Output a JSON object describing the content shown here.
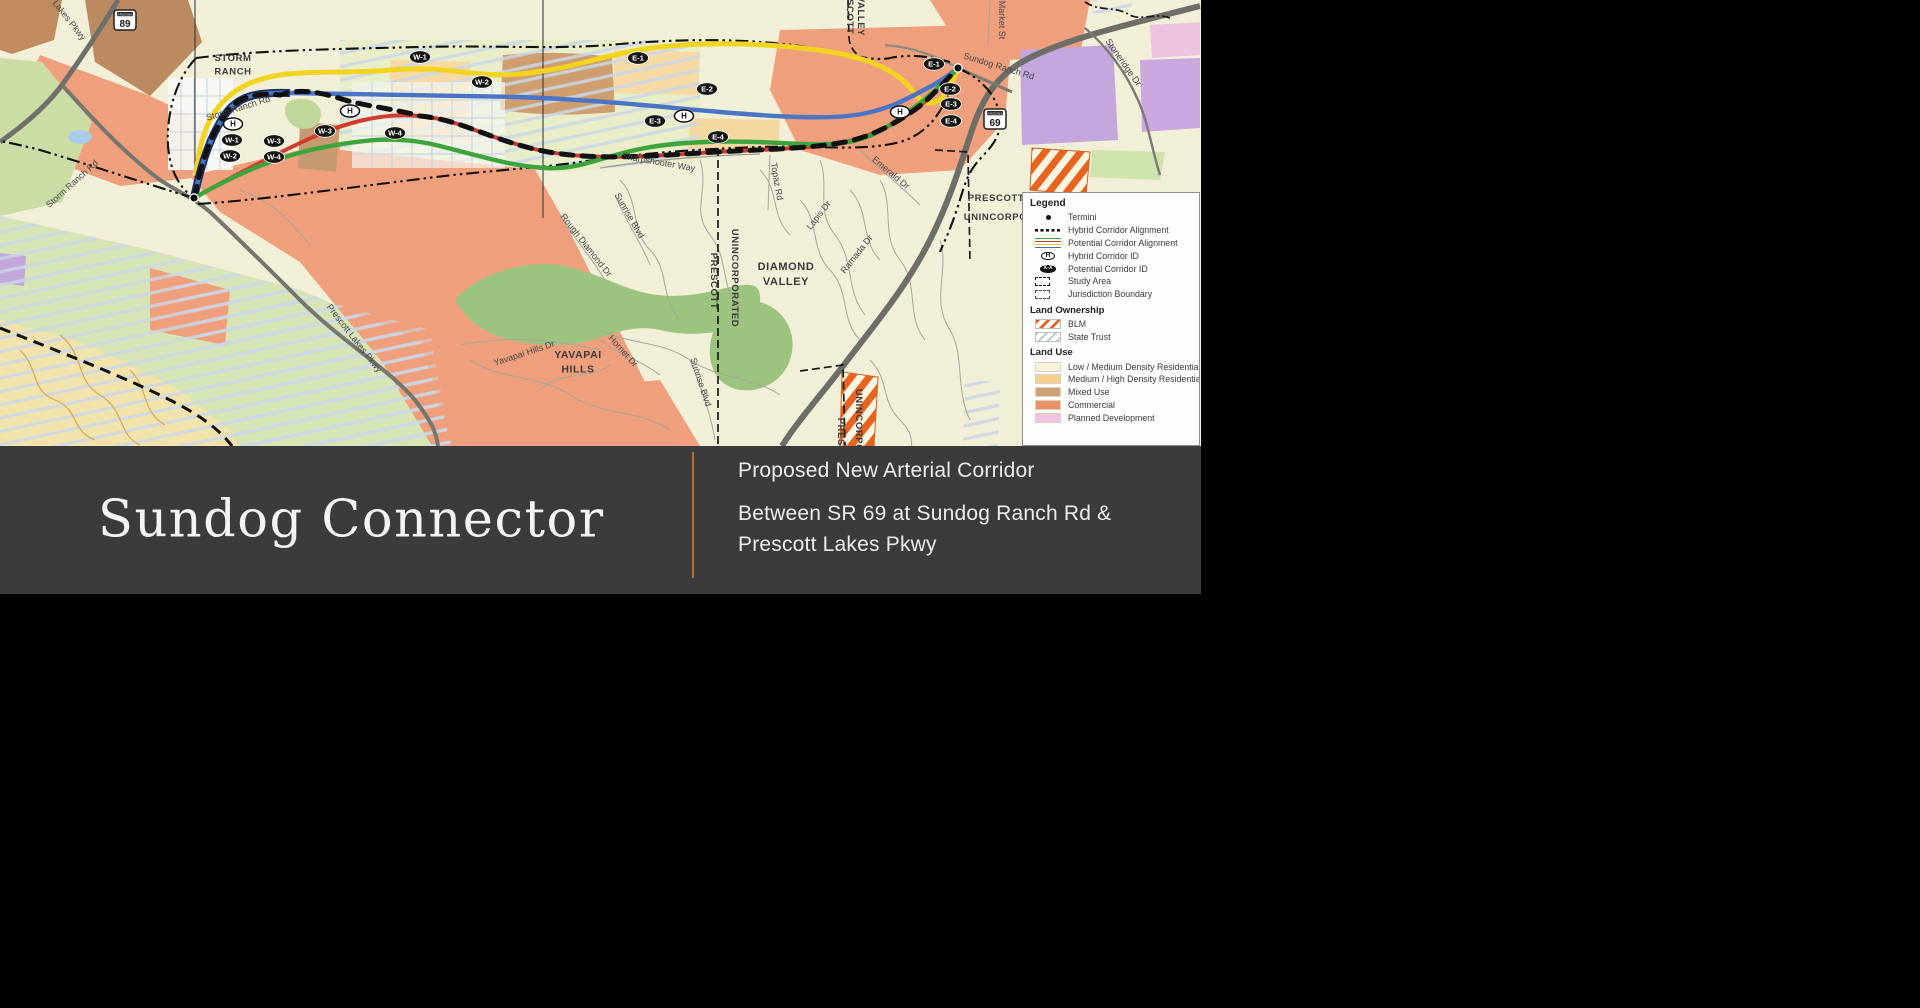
{
  "slide": {
    "title": "Sundog Connector",
    "subtitle_line1": "Proposed New Arterial Corridor",
    "subtitle_line2": "Between SR 69 at Sundog Ranch Rd &",
    "subtitle_line3": "Prescott Lakes Pkwy",
    "band_color": "#3b3b3e",
    "divider_color": "#b2702e",
    "background_color": "#000000"
  },
  "legend": {
    "title": "Legend",
    "items": [
      {
        "swatch": "termini-dot",
        "label": "Termini"
      },
      {
        "swatch": "hybrid-line",
        "label": "Hybrid Corridor Alignment"
      },
      {
        "swatch": "potential-lines",
        "label": "Potential Corridor Alignment"
      },
      {
        "swatch": "hybrid-id",
        "label": "Hybrid Corridor ID",
        "oval_text": "H"
      },
      {
        "swatch": "potential-id",
        "label": "Potential Corridor ID",
        "oval_text": "X-X"
      },
      {
        "swatch": "study-area",
        "label": "Study Area"
      },
      {
        "swatch": "jurisdiction",
        "label": "Jurisdiction Boundary"
      }
    ],
    "land_ownership": {
      "title": "Land Ownership",
      "items": [
        {
          "swatch": "blm-hatch",
          "label": "BLM"
        },
        {
          "swatch": "state-trust-hatch",
          "label": "State Trust"
        }
      ]
    },
    "land_use": {
      "title": "Land Use",
      "items": [
        {
          "swatch": "solid",
          "color": "#F7F2D8",
          "label": "Low / Medium Density Residential"
        },
        {
          "swatch": "solid",
          "color": "#F6D08F",
          "label": "Medium / High Density Residential"
        },
        {
          "swatch": "solid",
          "color": "#CFA377",
          "label": "Mixed Use"
        },
        {
          "swatch": "solid",
          "color": "#EE9066",
          "label": "Commercial"
        },
        {
          "swatch": "solid",
          "color": "#F2C4E0",
          "label": "Planned Development"
        }
      ]
    }
  },
  "map": {
    "corridor_colors": {
      "yellow": "#F2D41F",
      "blue": "#4A74C4",
      "red": "#D23B2F",
      "green": "#3DA43C",
      "hybrid": "#111111"
    },
    "termini": [
      {
        "x": 194,
        "y": 198
      },
      {
        "x": 958,
        "y": 68
      }
    ],
    "route_shields": [
      {
        "number": "89",
        "banner": "ARIZONA",
        "x": 125,
        "y": 20
      },
      {
        "number": "69",
        "banner": "ARIZONA",
        "x": 995,
        "y": 119
      }
    ],
    "badges": [
      {
        "label": "H",
        "x": 233,
        "y": 124,
        "type": "hybrid"
      },
      {
        "label": "W-1",
        "x": 232,
        "y": 140,
        "type": "potential"
      },
      {
        "label": "W-2",
        "x": 230,
        "y": 156,
        "type": "potential"
      },
      {
        "label": "W-3",
        "x": 274,
        "y": 141,
        "type": "potential"
      },
      {
        "label": "W-4",
        "x": 274,
        "y": 157,
        "type": "potential"
      },
      {
        "label": "H",
        "x": 350,
        "y": 111,
        "type": "hybrid"
      },
      {
        "label": "W-3",
        "x": 325,
        "y": 131,
        "type": "potential"
      },
      {
        "label": "W-4",
        "x": 395,
        "y": 133,
        "type": "potential"
      },
      {
        "label": "W-1",
        "x": 420,
        "y": 57,
        "type": "potential"
      },
      {
        "label": "W-2",
        "x": 482,
        "y": 82,
        "type": "potential"
      },
      {
        "label": "E-1",
        "x": 638,
        "y": 58,
        "type": "potential"
      },
      {
        "label": "E-2",
        "x": 707,
        "y": 89,
        "type": "potential"
      },
      {
        "label": "E-3",
        "x": 655,
        "y": 121,
        "type": "potential"
      },
      {
        "label": "H",
        "x": 684,
        "y": 116,
        "type": "hybrid"
      },
      {
        "label": "E-4",
        "x": 718,
        "y": 137,
        "type": "potential"
      },
      {
        "label": "H",
        "x": 900,
        "y": 112,
        "type": "hybrid"
      },
      {
        "label": "E-1",
        "x": 934,
        "y": 64,
        "type": "potential"
      },
      {
        "label": "E-2",
        "x": 950,
        "y": 89,
        "type": "potential"
      },
      {
        "label": "E-3",
        "x": 951,
        "y": 104,
        "type": "potential"
      },
      {
        "label": "E-4",
        "x": 951,
        "y": 121,
        "type": "potential"
      }
    ],
    "place_labels": [
      {
        "lines": [
          "STORM",
          "RANCH"
        ],
        "x": 233,
        "y": 61,
        "size": 9.5
      },
      {
        "lines": [
          "DIAMOND",
          "VALLEY"
        ],
        "x": 786,
        "y": 270,
        "size": 11
      },
      {
        "lines": [
          "YAVAPAI",
          "HILLS"
        ],
        "x": 578,
        "y": 358,
        "size": 10.5
      },
      {
        "lines": [
          "PRESCOTT"
        ],
        "x": 996,
        "y": 201,
        "size": 9.5
      },
      {
        "lines": [
          "UNINCORPORATED"
        ],
        "x": 1013,
        "y": 220,
        "size": 9.5
      },
      {
        "lines": [
          "UNINCORPORATED"
        ],
        "x": 732,
        "y": 278,
        "size": 9.5,
        "rot": 90
      },
      {
        "lines": [
          "PRESCOTT"
        ],
        "x": 711,
        "y": 281,
        "size": 9.5,
        "rot": 90
      },
      {
        "lines": [
          "UNINCORPORATED"
        ],
        "x": 856,
        "y": 438,
        "size": 9.5,
        "rot": 90
      },
      {
        "lines": [
          "PRESCOTT"
        ],
        "x": 838,
        "y": 446,
        "size": 9.5,
        "rot": 90
      },
      {
        "lines": [
          "PRESCOTT"
        ],
        "x": 847,
        "y": 6,
        "size": 9.5,
        "rot": 90
      },
      {
        "lines": [
          "VALLEY"
        ],
        "x": 858,
        "y": 16,
        "size": 9.5,
        "rot": 90
      }
    ],
    "road_labels": [
      {
        "text": "Lakes Pkwy",
        "x": 67,
        "y": 22,
        "rot": 52
      },
      {
        "text": "Storm Ranch Rd",
        "x": 74,
        "y": 186,
        "rot": -42
      },
      {
        "text": "Storm Ranch Rd",
        "x": 239,
        "y": 111,
        "rot": -17
      },
      {
        "text": "Prescott Lakes Pkwy",
        "x": 352,
        "y": 340,
        "rot": 52
      },
      {
        "text": "Sharpshooter Way",
        "x": 658,
        "y": 165,
        "rot": 10
      },
      {
        "text": "Sunrise Blvd",
        "x": 627,
        "y": 217,
        "rot": 60
      },
      {
        "text": "Rough Diamond Dr",
        "x": 584,
        "y": 247,
        "rot": 52
      },
      {
        "text": "Topaz Rd",
        "x": 774,
        "y": 182,
        "rot": 80
      },
      {
        "text": "Lapis Dr",
        "x": 821,
        "y": 217,
        "rot": -52
      },
      {
        "text": "Emerald Dr",
        "x": 889,
        "y": 175,
        "rot": 40
      },
      {
        "text": "Ramada Dr",
        "x": 859,
        "y": 256,
        "rot": -52
      },
      {
        "text": "Yavapai Hills Dr",
        "x": 525,
        "y": 356,
        "rot": -18
      },
      {
        "text": "Hornet Dr",
        "x": 621,
        "y": 353,
        "rot": 48
      },
      {
        "text": "Sunrise Blvd",
        "x": 698,
        "y": 383,
        "rot": 72
      },
      {
        "text": "Sundog Ranch Rd",
        "x": 998,
        "y": 69,
        "rot": 17
      },
      {
        "text": "Stoneridge Dr",
        "x": 1121,
        "y": 64,
        "rot": 55
      },
      {
        "text": "Market St",
        "x": 999,
        "y": 20,
        "rot": 90
      }
    ]
  }
}
